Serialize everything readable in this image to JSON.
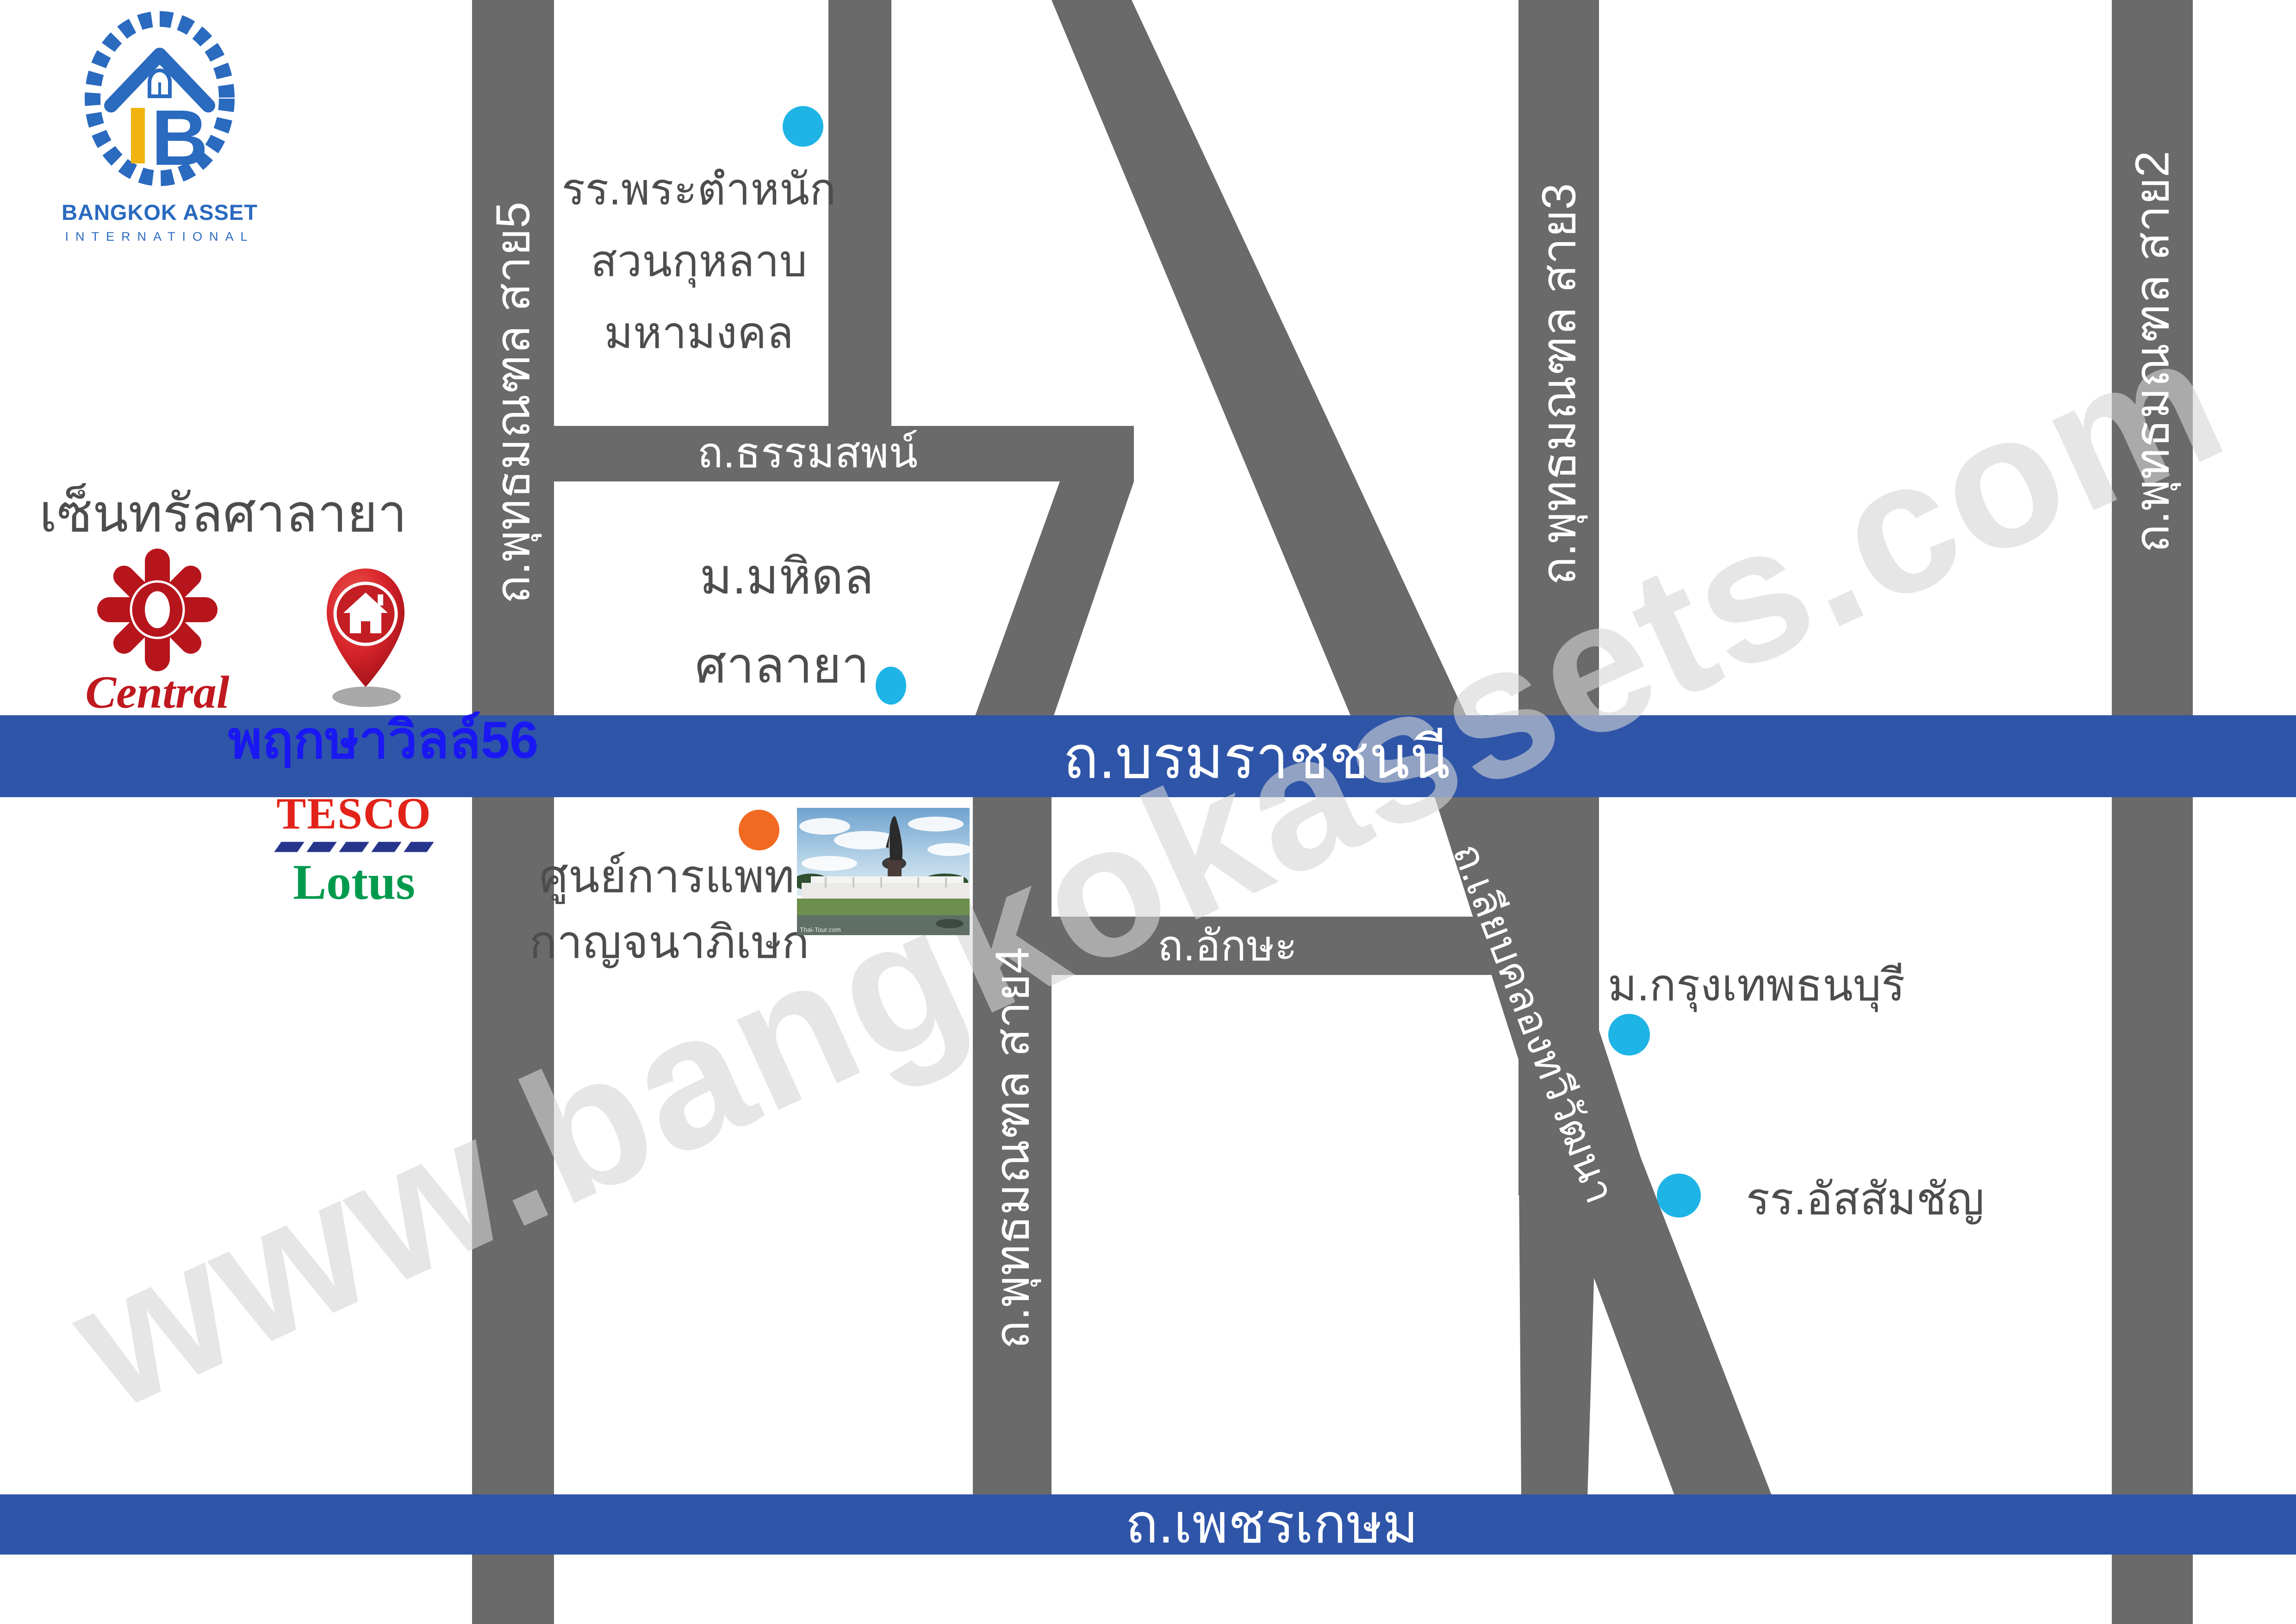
{
  "logo": {
    "title": "BANGKOK ASSET",
    "subtitle": "INTERNATIONAL"
  },
  "watermark": "www.bangkokassets.com",
  "roads": {
    "sai5": "ถ.พุทธมณฑล สาย5",
    "sai4": "ถ.พุทธมณฑล สาย4",
    "sai3": "ถ.พุทธมณฑล สาย3",
    "sai2": "ถ.พุทธมณฑล สาย2",
    "thammasop": "ถ.ธรรมสพน์",
    "aksa": "ถ.อักษะ",
    "liabklong": "ถ.เลียบคลองทวีวัฒนา",
    "borommaratchachonnani": "ถ.บรมราชชนนี",
    "phetkasem": "ถ.เพชรเกษม"
  },
  "landmarks": {
    "school": {
      "line1": "รร.พระตำหนัก",
      "line2": "สวนกุหลาบ",
      "line3": "มหามงคล"
    },
    "mahidol": {
      "line1": "ม.มหิดล",
      "line2": "ศาลายา"
    },
    "central": {
      "title": "เซ็นทรัลศาลายา",
      "logo_text": "Central"
    },
    "pruksa": {
      "label": "พฤกษาวิลล์56"
    },
    "tesco": {
      "line1": "TESCO",
      "line2": "Lotus"
    },
    "medical": {
      "line1": "ศูนย์การแพทย์",
      "line2": "กาญจนาภิเษก"
    },
    "bkk_thonburi": {
      "label": "ม.กรุงเทพธนบุรี"
    },
    "assumption": {
      "label": "รร.อัสสัมชัญ"
    },
    "photo_caption": "Thai-Tour.com"
  },
  "colors": {
    "road_gray": "#6a6a6a",
    "highway_blue": "#2f55a8",
    "marker_cyan": "#1fb4e6",
    "marker_orange": "#f26a21",
    "label_dark": "#4d4d4d",
    "pruksa_blue": "#1a18f2",
    "tesco_red": "#e2231a",
    "tesco_navy": "#26358c",
    "lotus_green": "#009a4d",
    "central_red": "#c0181f",
    "pin_red": "#d6232a",
    "logo_blue": "#2a6abf",
    "logo_yellow": "#f0b310",
    "watermark_gray": "#d5d5d5"
  }
}
